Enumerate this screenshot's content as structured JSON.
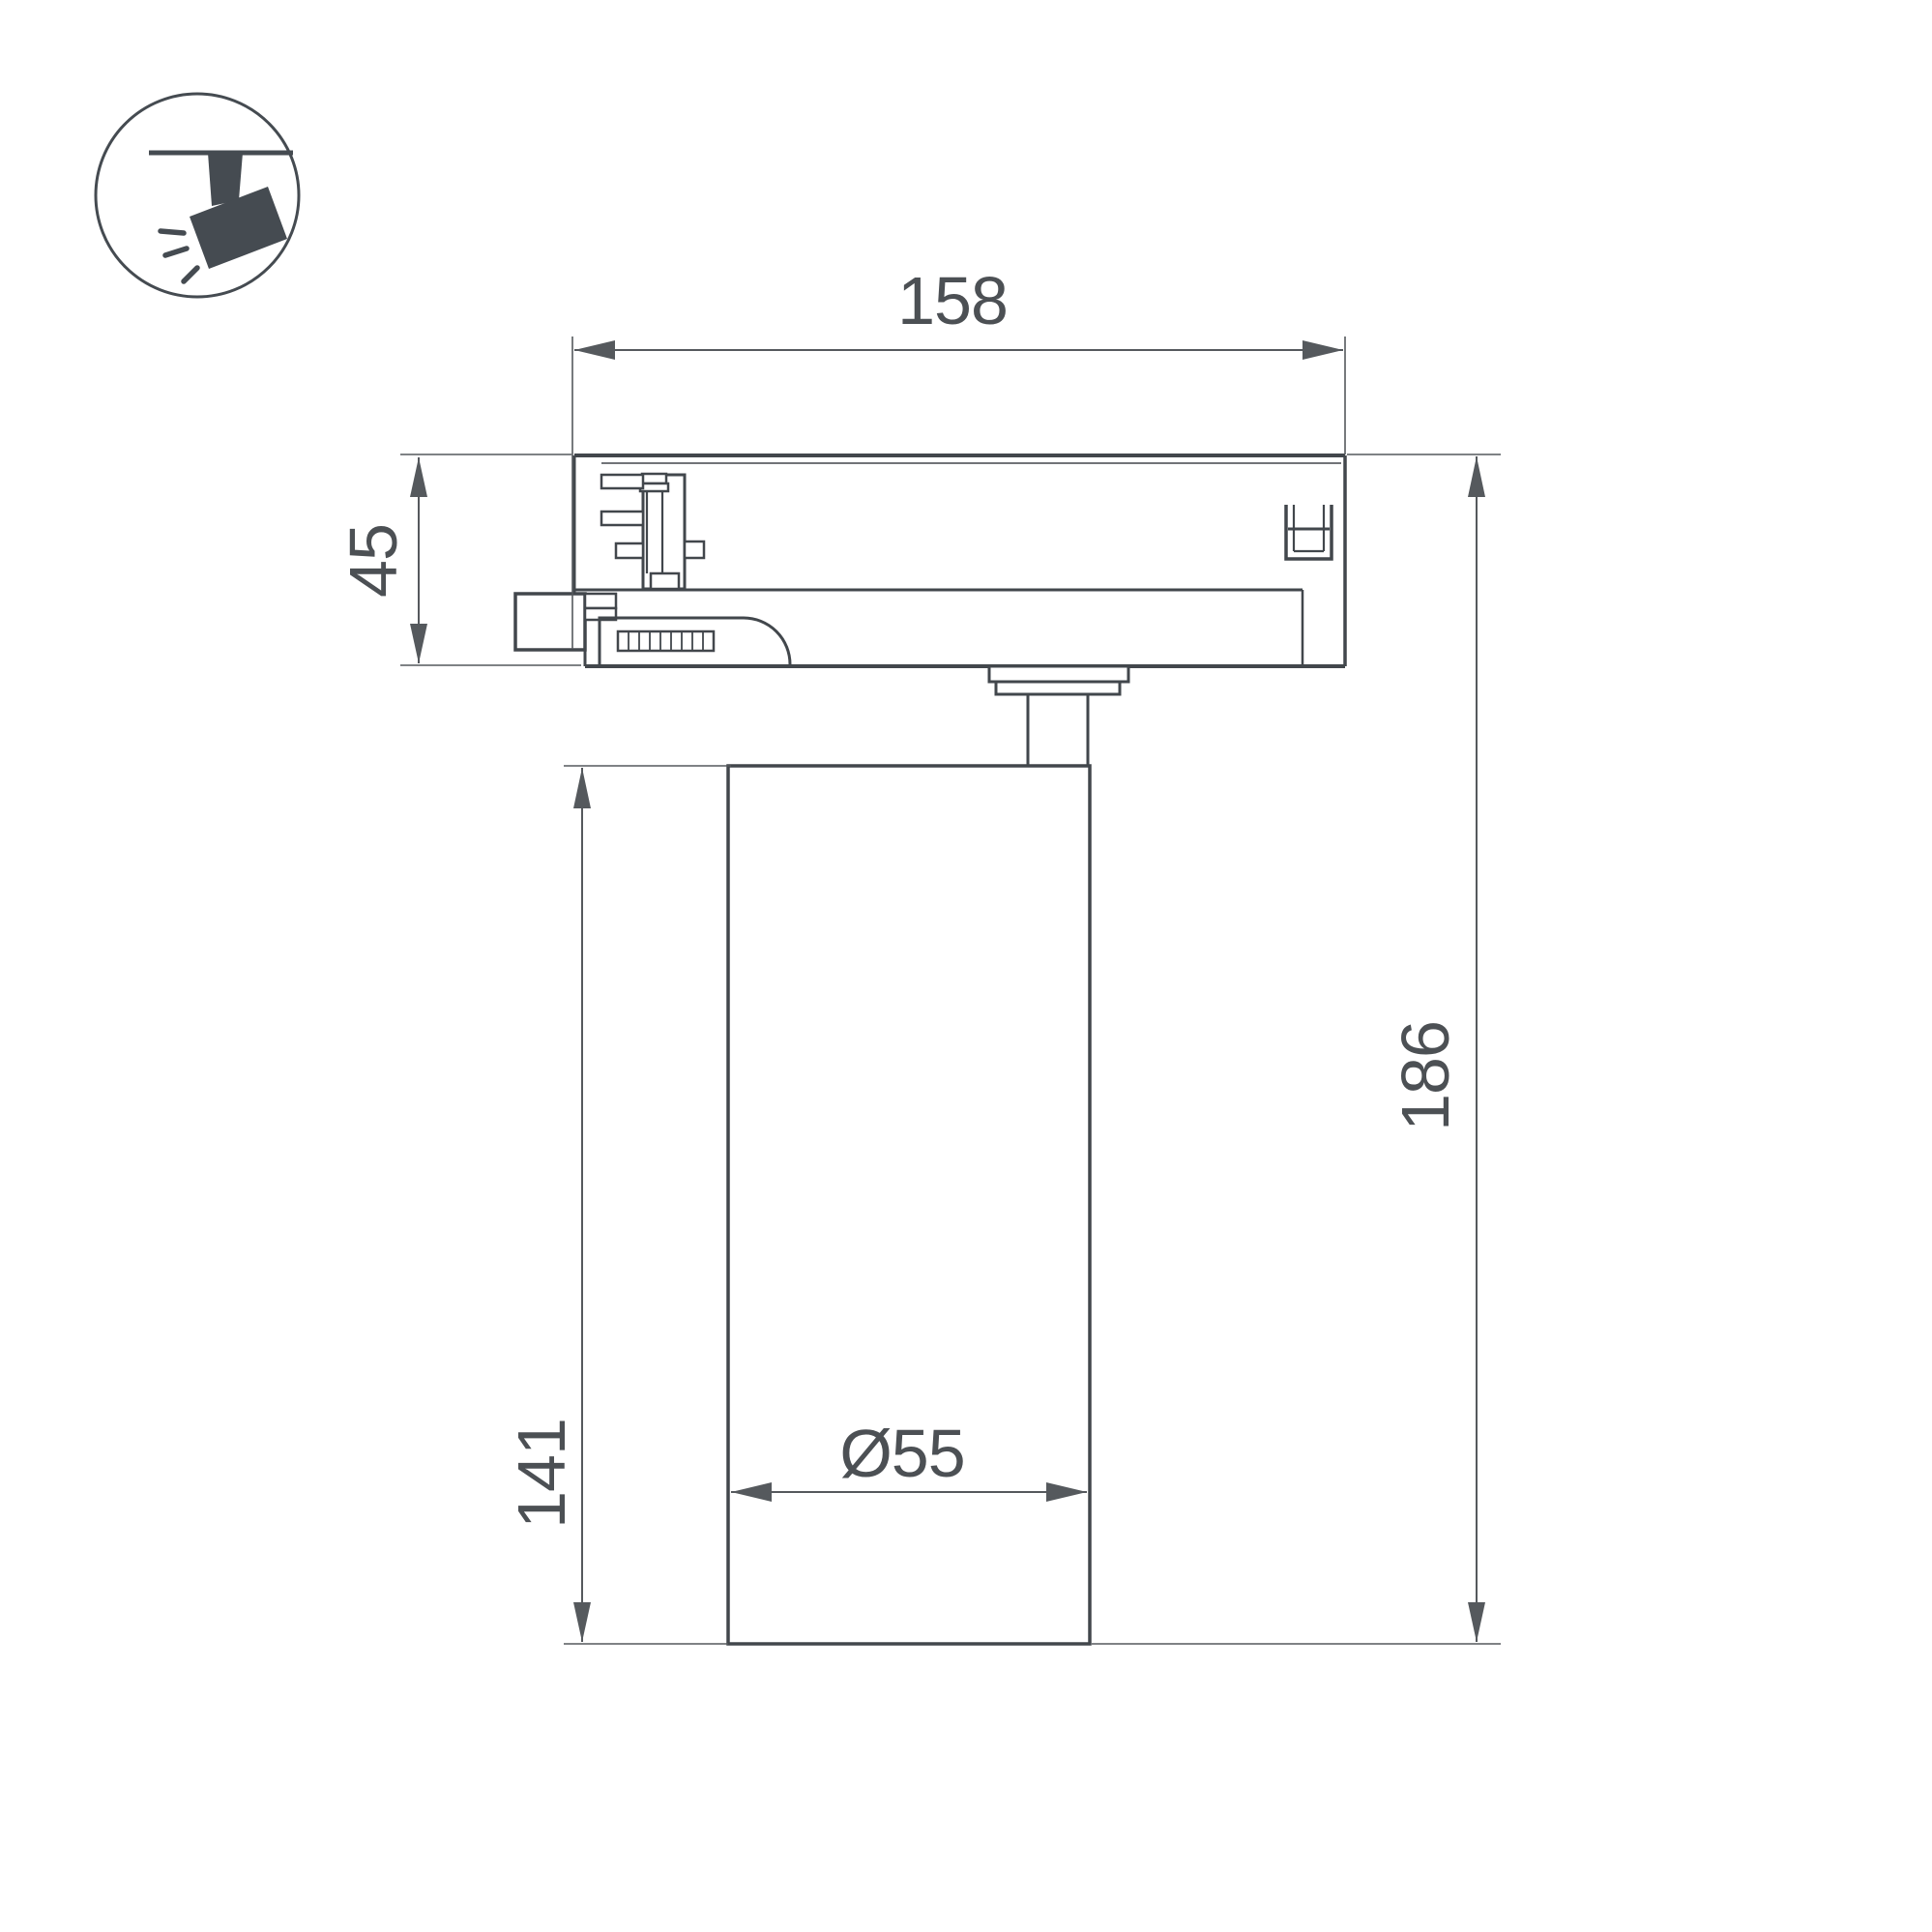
{
  "colors": {
    "outline": "#42474c",
    "dimension": "#55595d",
    "text": "#4c5054",
    "icon": "#454b51",
    "background": "#ffffff"
  },
  "icon": {
    "name": "track-spotlight-icon"
  },
  "drawing": {
    "dims": {
      "track_adapter_width": "158",
      "track_adapter_height": "45",
      "lamp_body_height": "141",
      "total_height": "186",
      "lamp_body_diameter": "Ø55"
    }
  }
}
